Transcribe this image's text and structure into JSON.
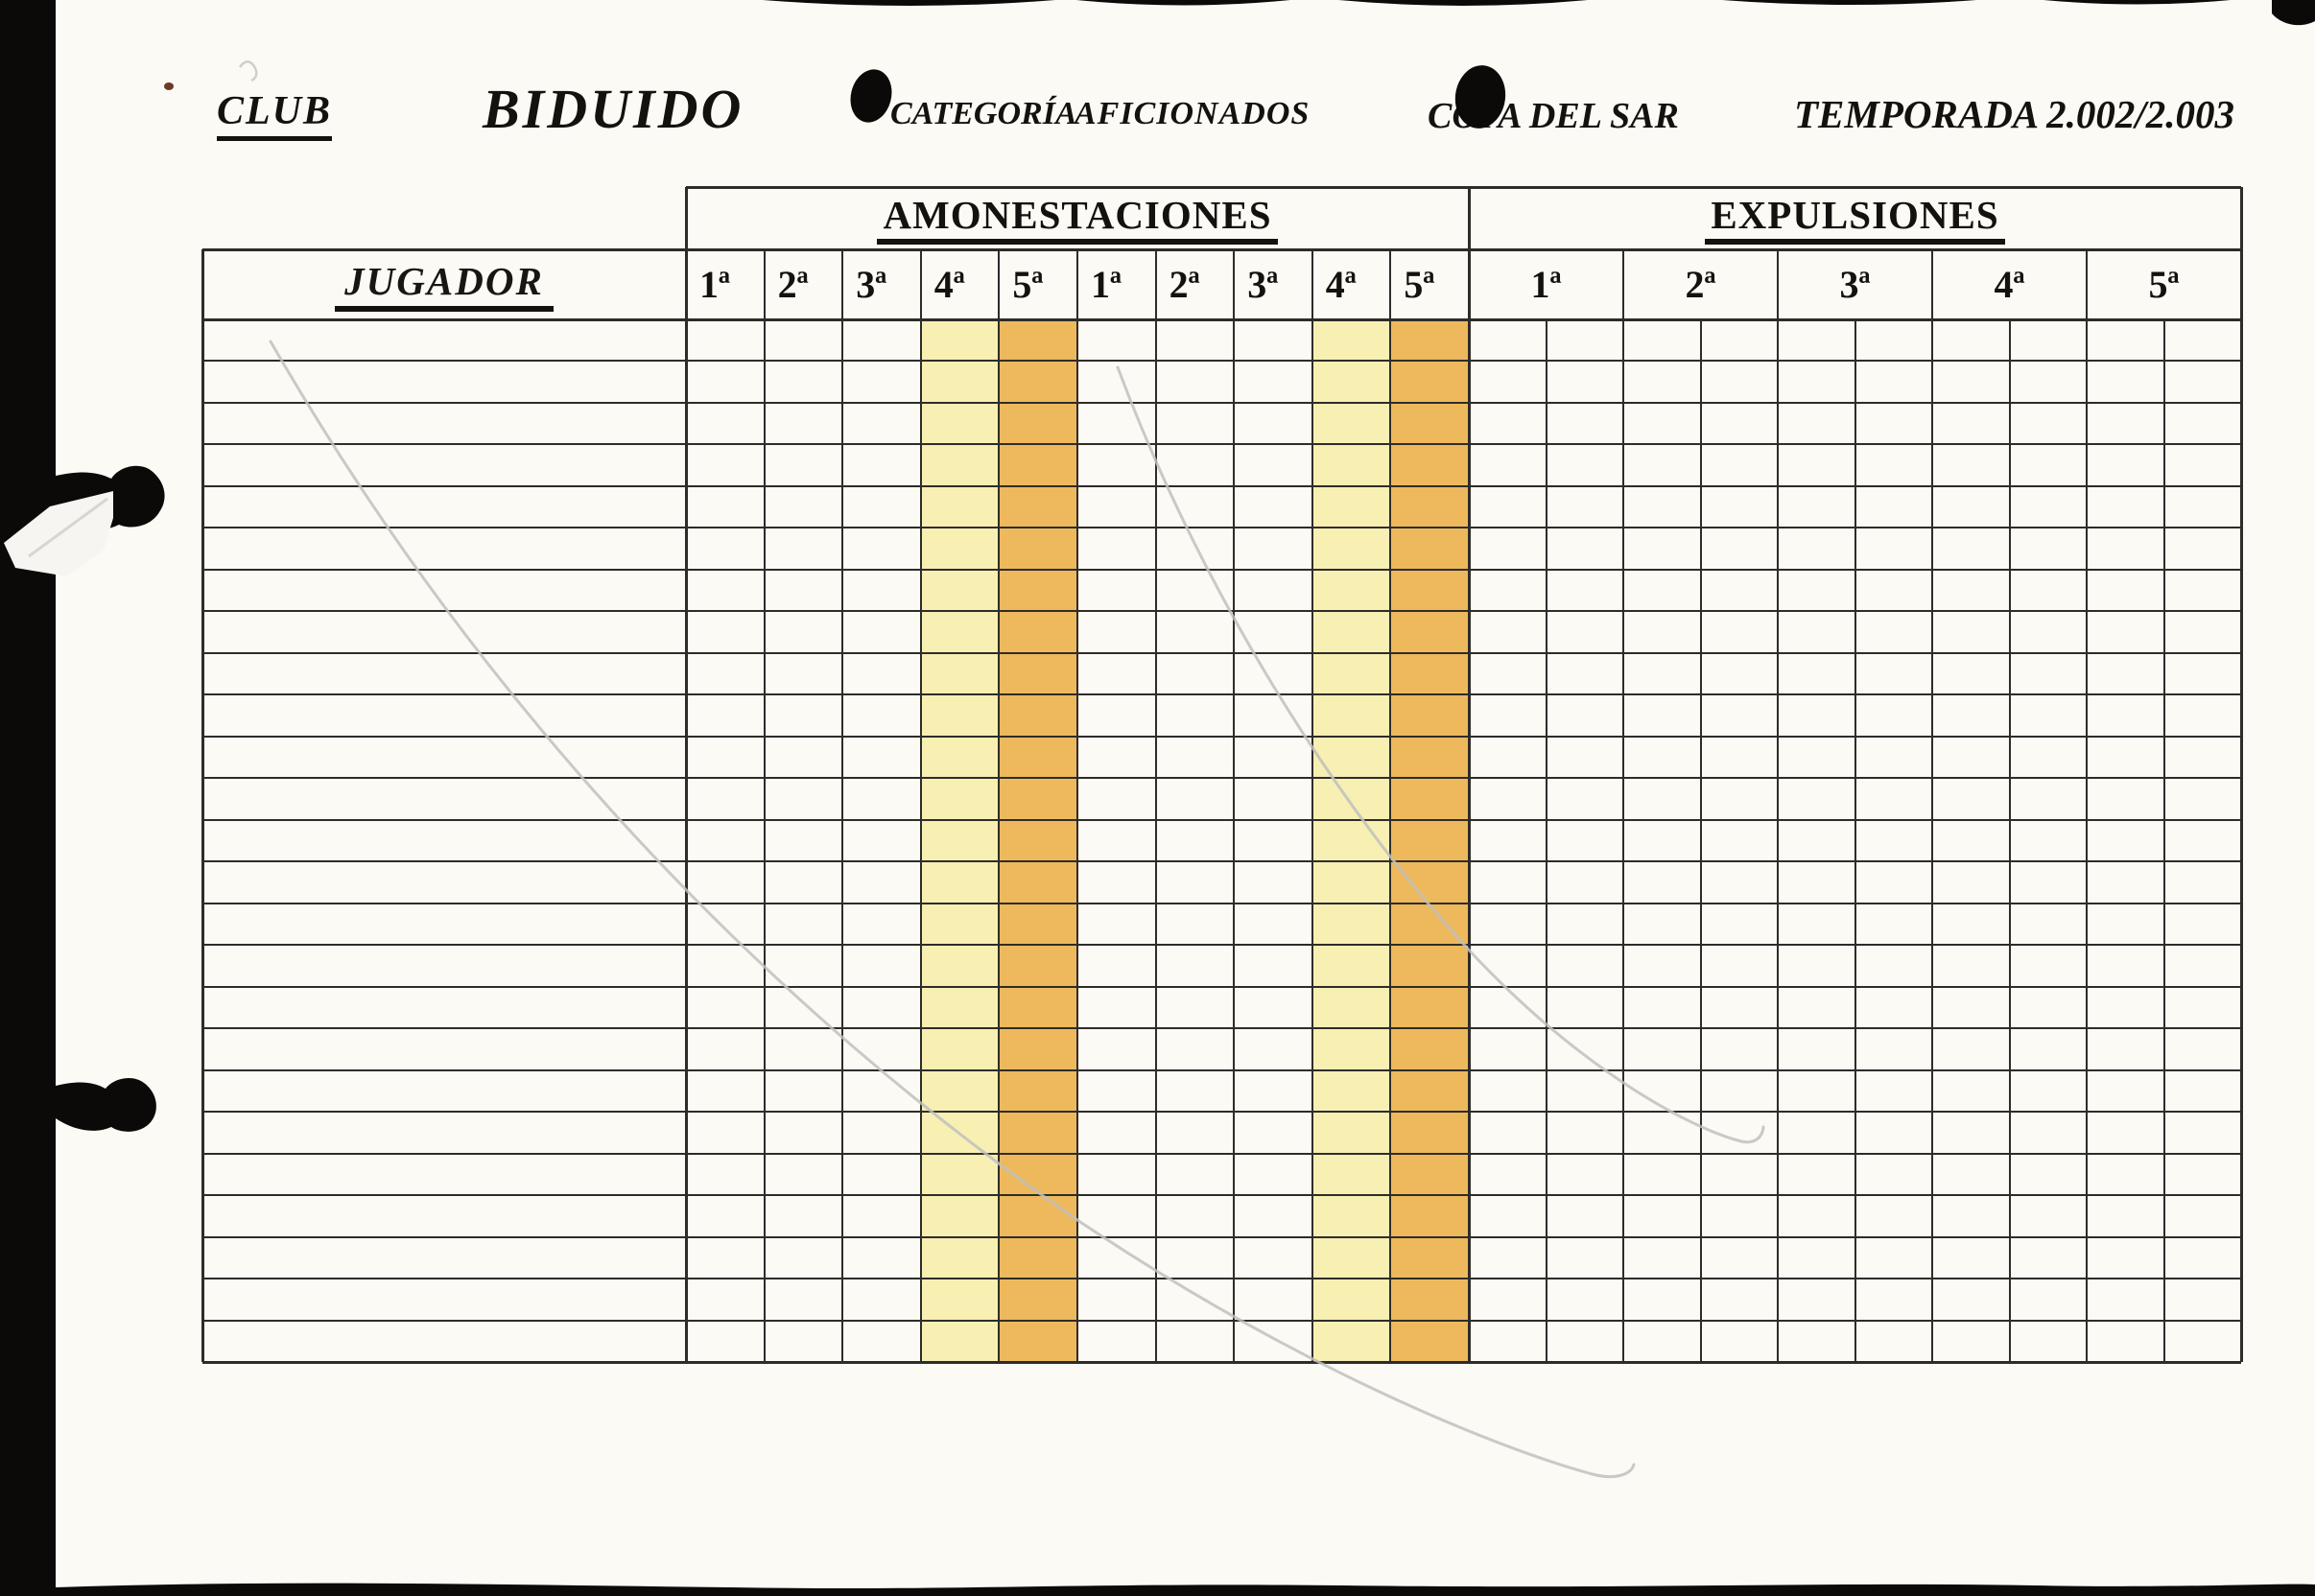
{
  "header": {
    "club_label": "CLUB",
    "club_name": "BIDUIDO",
    "category_label": "CATEGORÍA",
    "category_value": "AFICIONADOS",
    "competition": "COPA DEL SAR",
    "season": "TEMPORADA 2.002/2.003"
  },
  "table": {
    "player_column_header": "JUGADOR",
    "sections": [
      {
        "title": "AMONESTACIONES",
        "columns": [
          "1ª",
          "2ª",
          "3ª",
          "4ª",
          "5ª",
          "1ª",
          "2ª",
          "3ª",
          "4ª",
          "5ª"
        ],
        "highlight_cream_indices": [
          3,
          8
        ],
        "highlight_orange_indices": [
          4,
          9
        ]
      },
      {
        "title": "EXPULSIONES",
        "columns": [
          "1ª",
          "2ª",
          "3ª",
          "4ª",
          "5ª"
        ]
      }
    ],
    "body_row_count": 25,
    "body_cells_empty": true
  },
  "colors": {
    "paper": "#fbfaf5",
    "grid_line": "#2e2c29",
    "highlight_cream": "#f8efb3",
    "highlight_orange": "#edb95c",
    "pencil_stroke": "#c0bfbd",
    "scan_mark": "#0b0a09"
  }
}
